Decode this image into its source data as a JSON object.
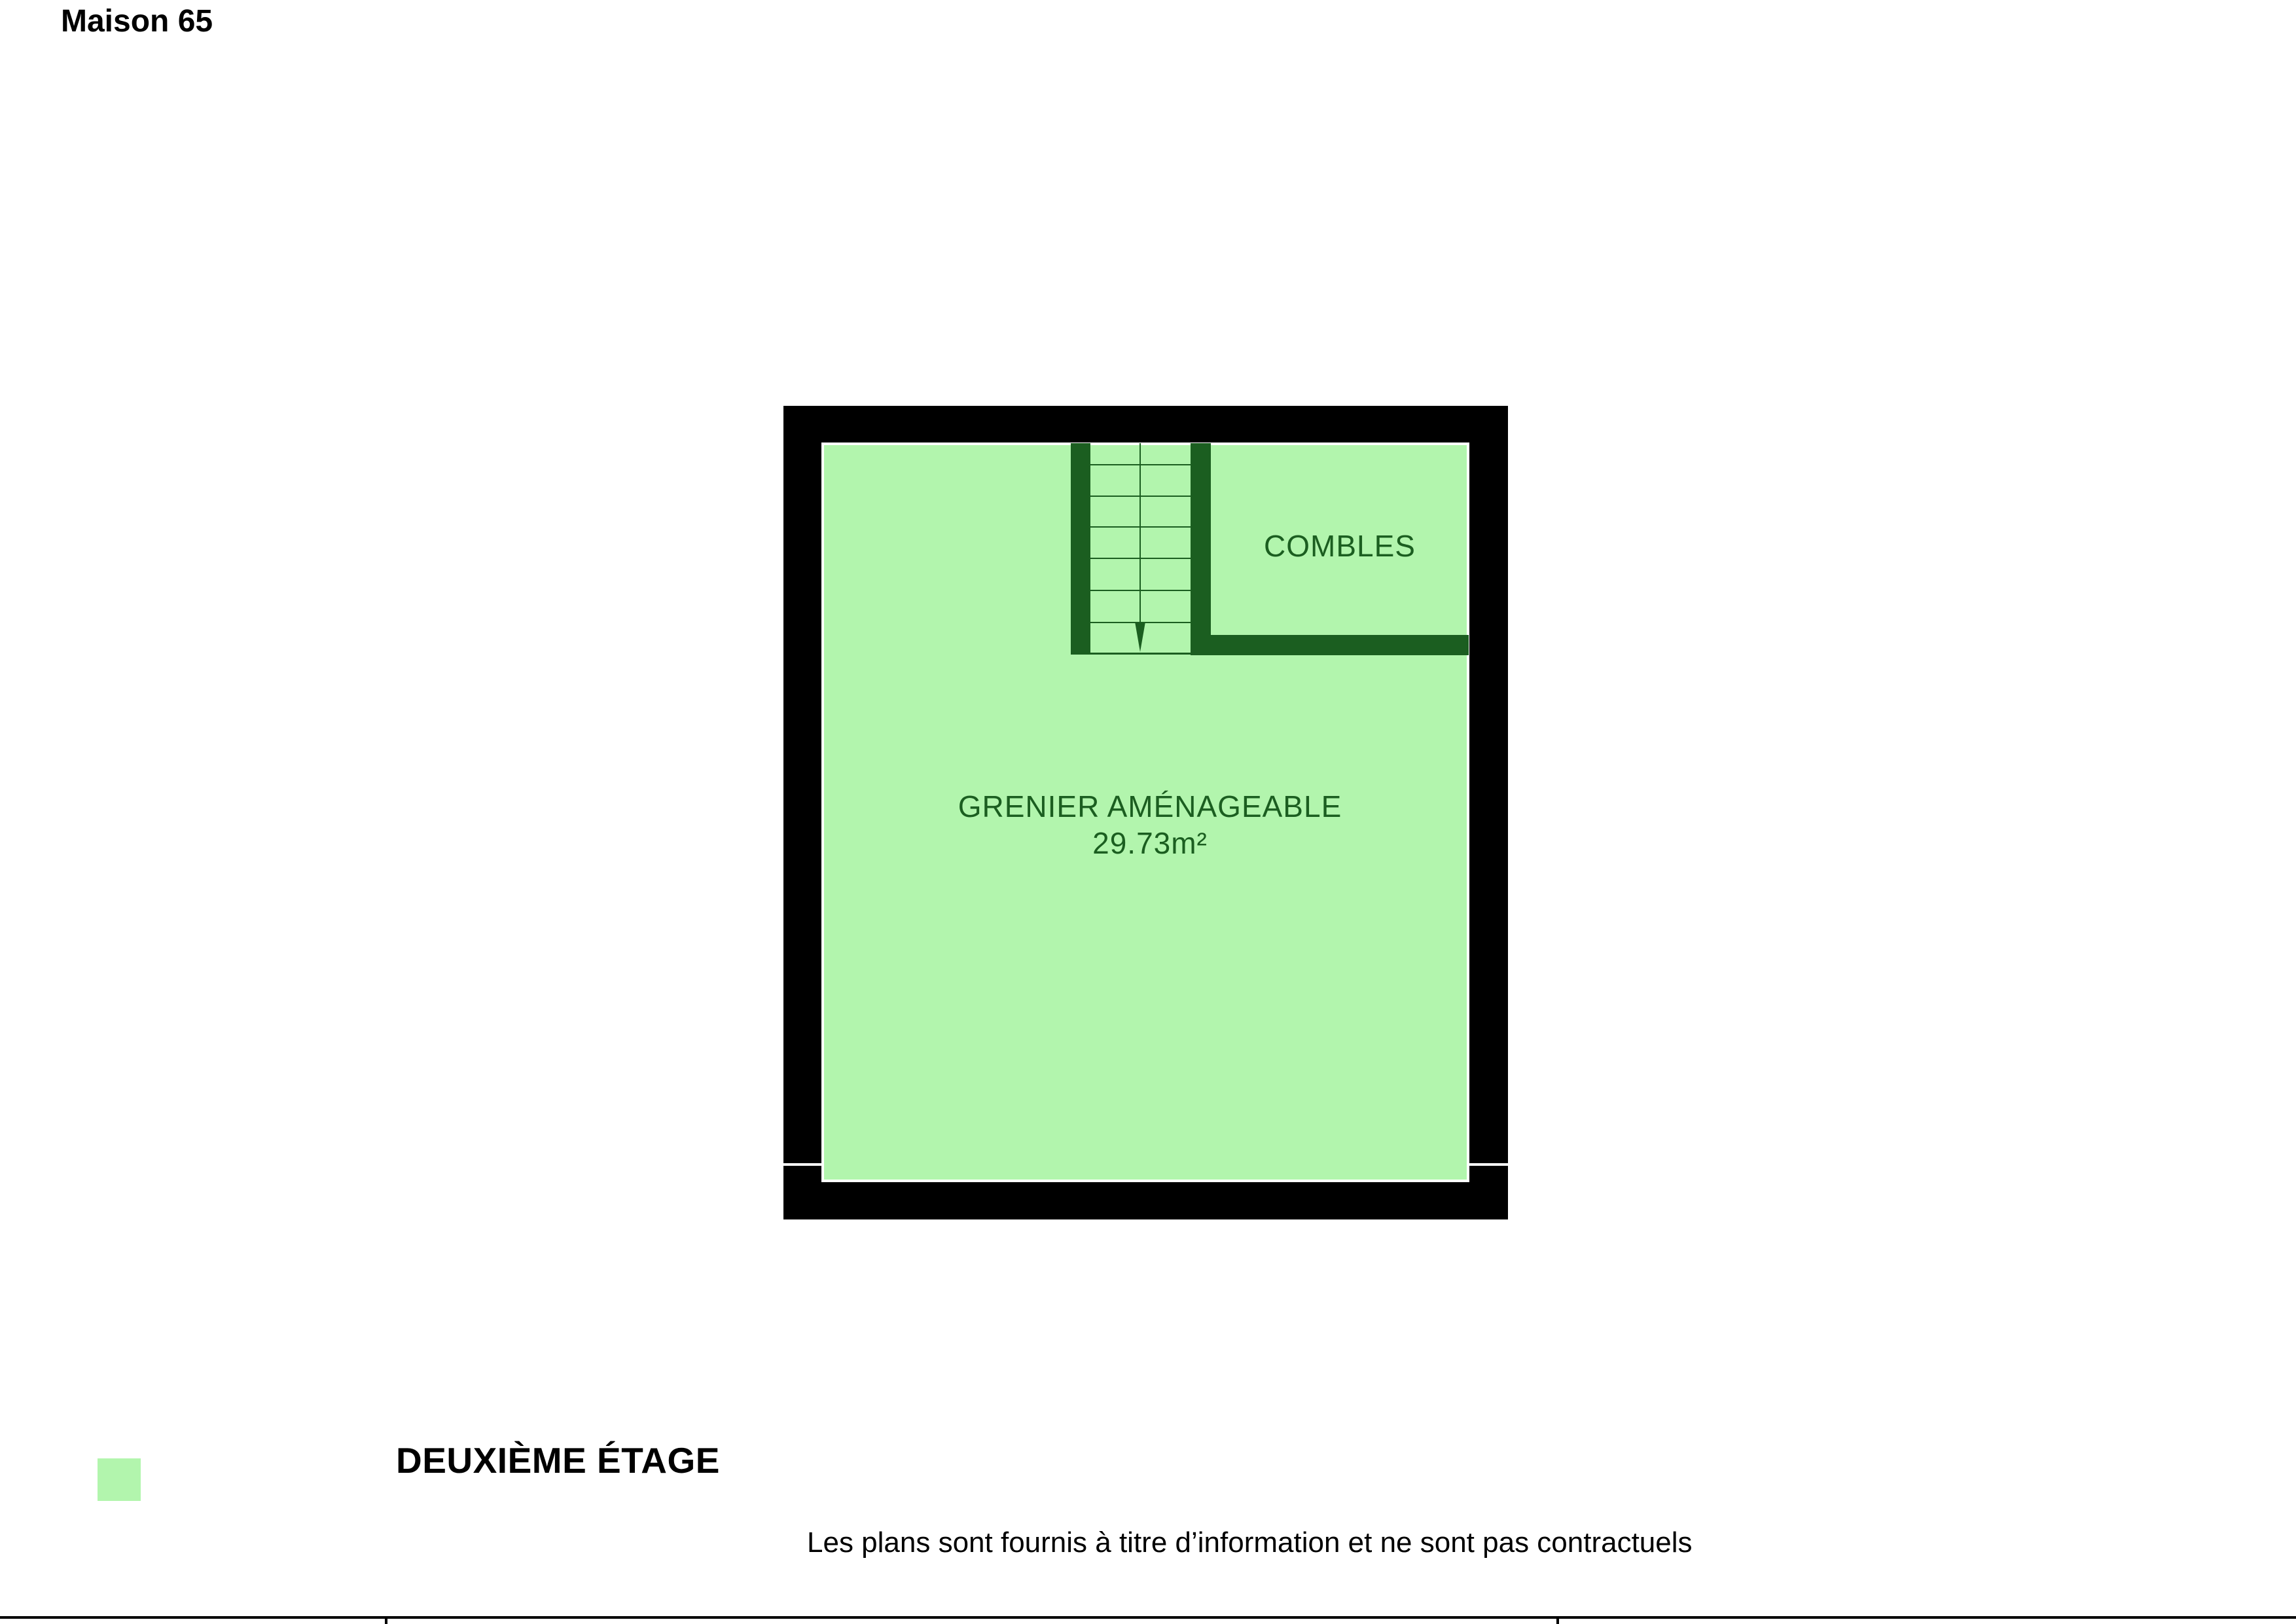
{
  "colors": {
    "room_fill": "#b2f5ad",
    "outer_wall": "#000000",
    "inner_wall": "#1b5e20",
    "label_text": "#1b5e20",
    "annotation_text": "#000000",
    "page_background": "#ffffff"
  },
  "floorplan": {
    "rooms": [
      {
        "id": "combles",
        "label": "COMBLES"
      },
      {
        "id": "grenier",
        "label": "GRENIER AMÉNAGEABLE",
        "area": "29.73m²"
      }
    ],
    "stairs": {
      "tread_line_offsets": [
        32,
        80,
        127,
        175,
        224,
        273
      ],
      "direction": "down"
    }
  },
  "legend": {
    "swatch_color": "#b2f5ad",
    "label": "Maison 65"
  },
  "title_block": {
    "floor_title": "DEUXIÈME ÉTAGE"
  },
  "disclaimer": "Les plans sont fournis à titre d’information et ne sont pas contractuels"
}
